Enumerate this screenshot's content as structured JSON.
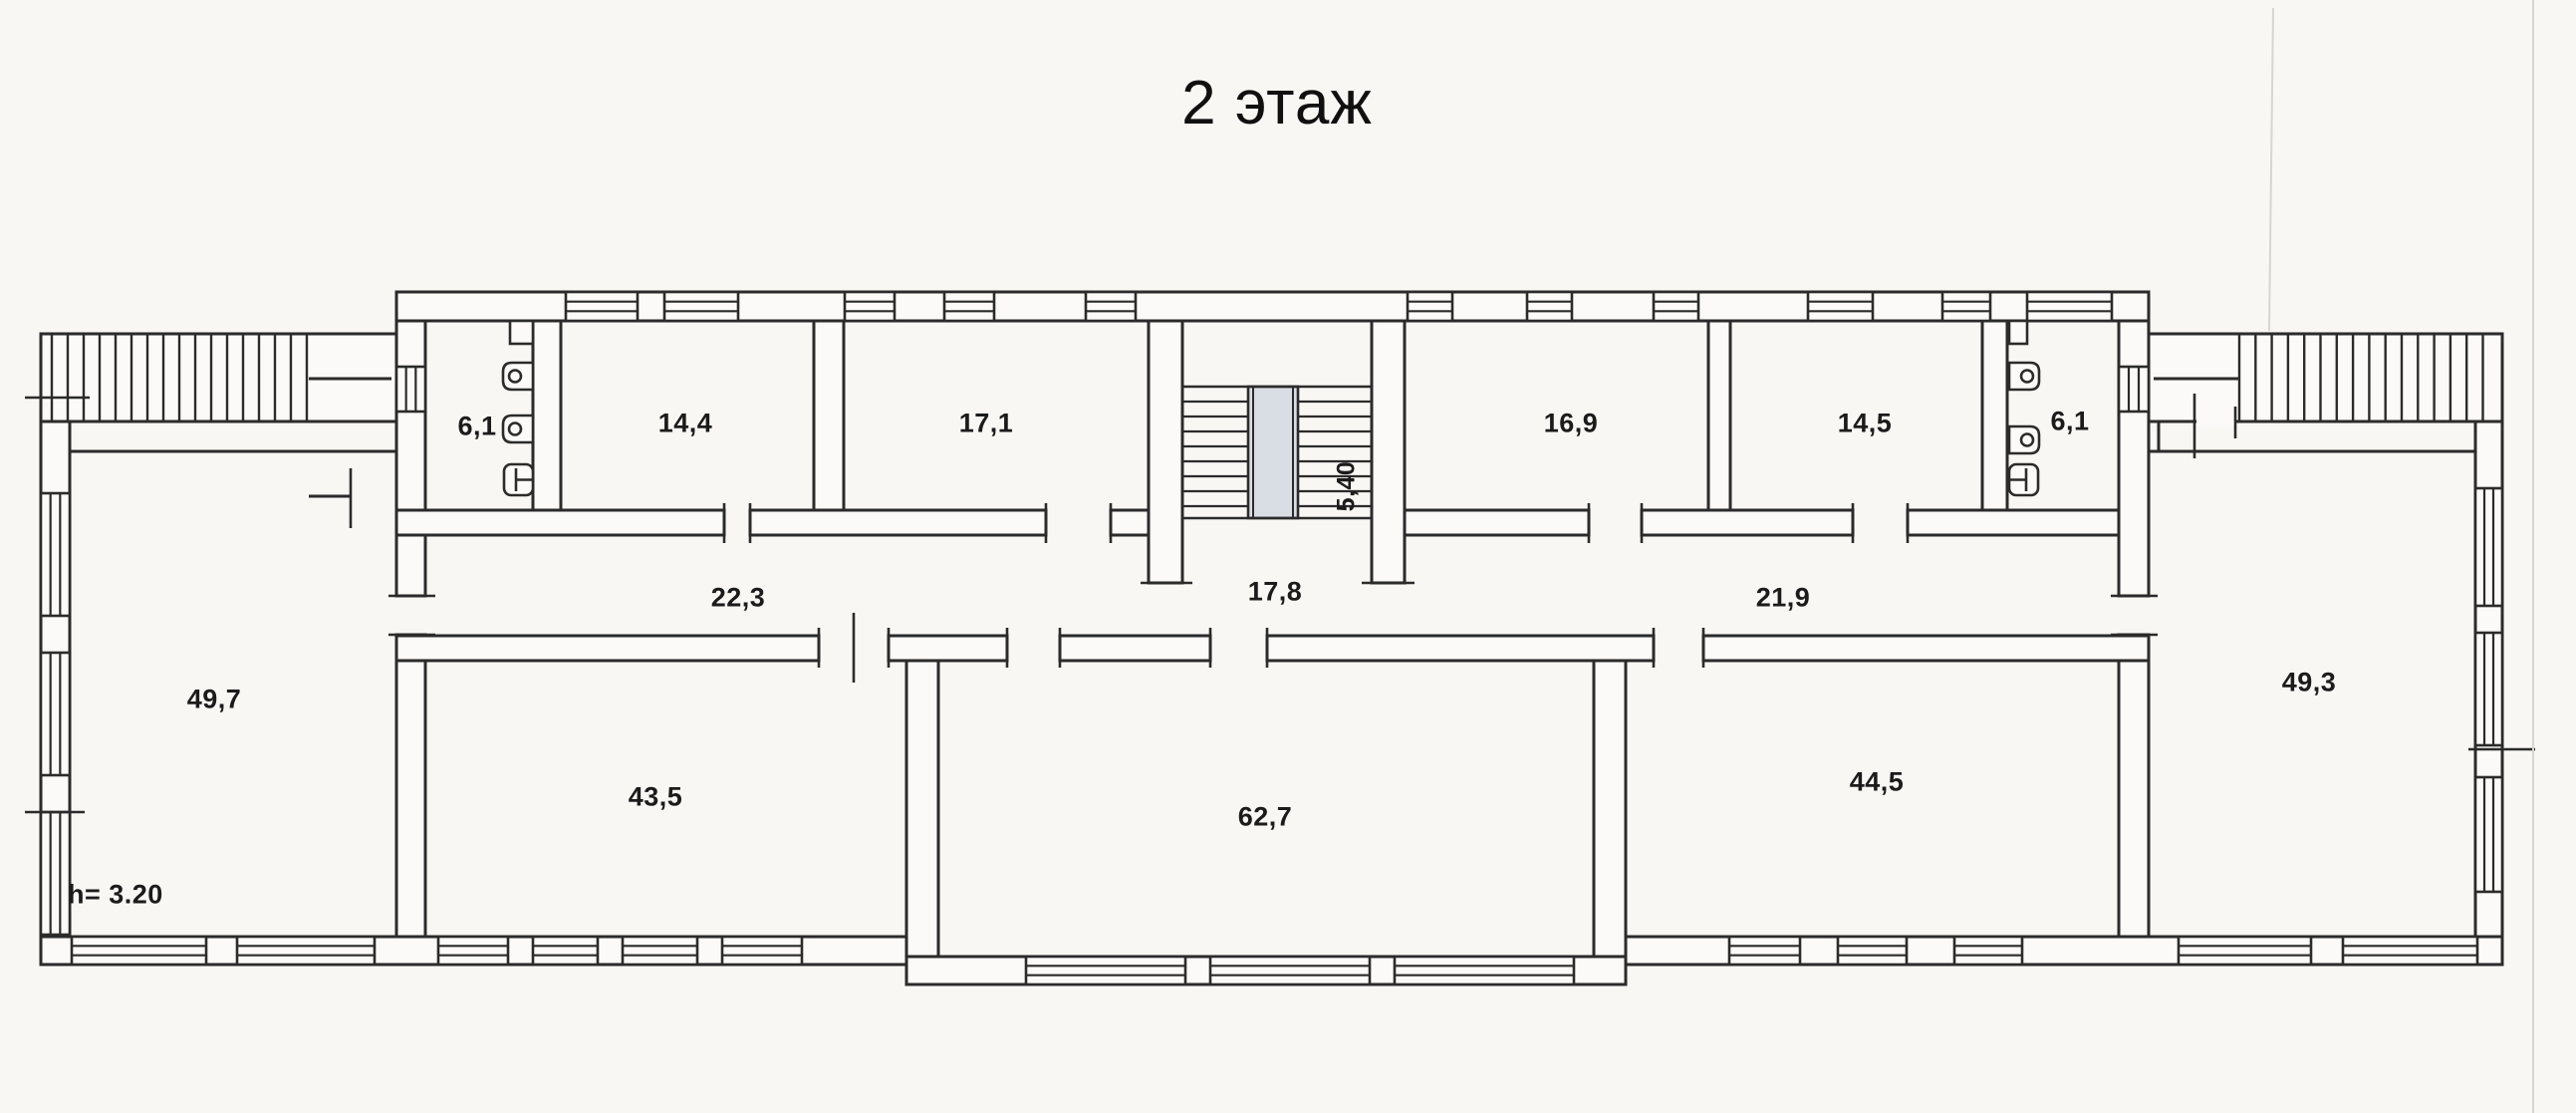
{
  "title": "2 этаж",
  "plan": {
    "floor_height_note": "h= 3.20",
    "stair_width_dimension": "5,40"
  },
  "rooms": [
    {
      "id": "wc-left",
      "area": "6,1"
    },
    {
      "id": "room-14-4",
      "area": "14,4"
    },
    {
      "id": "room-17-1",
      "area": "17,1"
    },
    {
      "id": "room-16-9",
      "area": "16,9"
    },
    {
      "id": "room-14-5",
      "area": "14,5"
    },
    {
      "id": "wc-right",
      "area": "6,1"
    },
    {
      "id": "corridor-left",
      "area": "22,3"
    },
    {
      "id": "stair-hall",
      "area": "17,8"
    },
    {
      "id": "corridor-right",
      "area": "21,9"
    },
    {
      "id": "room-49-7",
      "area": "49,7"
    },
    {
      "id": "room-43-5",
      "area": "43,5"
    },
    {
      "id": "room-62-7",
      "area": "62,7"
    },
    {
      "id": "room-44-5",
      "area": "44,5"
    },
    {
      "id": "room-49-3",
      "area": "49,3"
    }
  ],
  "colors": {
    "ink": "#2b2b2b",
    "paper": "#fbfaf8",
    "stair_landing_fill": "#d9dde4",
    "crease": "#d8d5d0"
  }
}
